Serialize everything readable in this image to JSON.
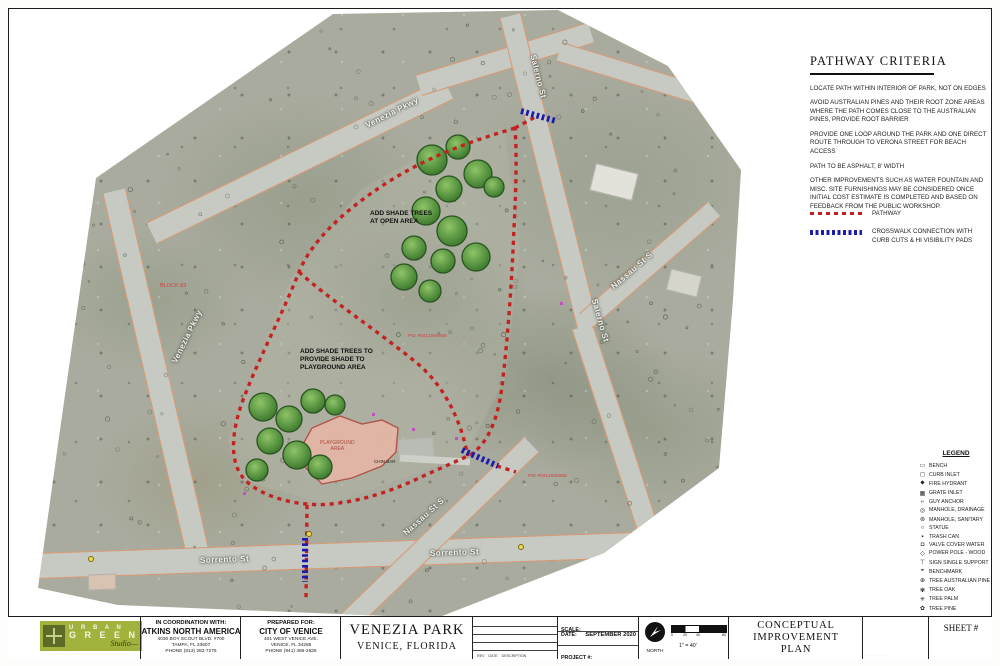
{
  "criteria": {
    "title": "PATHWAY CRITERIA",
    "paragraphs": [
      "LOCATE PATH WITHIN INTERIOR OF PARK, NOT ON EDGES",
      "AVOID AUSTRALIAN PINES AND THEIR ROOT ZONE AREAS WHERE THE PATH COMES CLOSE TO THE AUSTRALIAN PINES, PROVIDE ROOT BARRIER",
      "PROVIDE ONE LOOP AROUND THE PARK AND ONE DIRECT ROUTE THROUGH TO VERONA STREET FOR BEACH ACCESS",
      "PATH TO BE ASPHALT, 8' WIDTH",
      "OTHER IMPROVEMENTS SUCH AS WATER FOUNTAIN AND MISC. SITE FURNISHINGS MAY BE CONSIDERED ONCE INITIAL COST ESTIMATE IS COMPLETED AND BASED ON FEEDBACK FROM THE PUBLIC WORKSHOP."
    ],
    "pathway_label": "PATHWAY",
    "crosswalk_label": "CROSSWALK CONNECTION WITH CURB CUTS & HI VISIBILITY PADS",
    "pathway_color": "#c41f1f",
    "crosswalk_color": "#1c1caa"
  },
  "legend": {
    "title": "LEGEND",
    "items": [
      {
        "glyph": "▭",
        "label": "BENCH"
      },
      {
        "glyph": "◻",
        "label": "CURB INLET"
      },
      {
        "glyph": "⬥",
        "label": "FIRE HYDRANT"
      },
      {
        "glyph": "▦",
        "label": "GRATE INLET"
      },
      {
        "glyph": "⌐",
        "label": "GUY ANCHOR"
      },
      {
        "glyph": "◎",
        "label": "MANHOLE, DRAINAGE"
      },
      {
        "glyph": "⊚",
        "label": "MANHOLE, SANITARY"
      },
      {
        "glyph": "○",
        "label": "STATUE"
      },
      {
        "glyph": "▪",
        "label": "TRASH CAN"
      },
      {
        "glyph": "◘",
        "label": "VALVE COVER WATER"
      },
      {
        "glyph": "◇",
        "label": "POWER POLE - WOOD"
      },
      {
        "glyph": "⊤",
        "label": "SIGN SINGLE SUPPORT"
      },
      {
        "glyph": "⌖",
        "label": "BENCHMARK"
      },
      {
        "glyph": "⊕",
        "label": "TREE AUSTRALIAN PINE"
      },
      {
        "glyph": "✾",
        "label": "TREE OAK"
      },
      {
        "glyph": "✳",
        "label": "TREE PALM"
      },
      {
        "glyph": "✿",
        "label": "TREE PINE"
      }
    ]
  },
  "map": {
    "street_labels": [
      {
        "text": "Venezia Pkwy"
      },
      {
        "text": "Salerno St"
      },
      {
        "text": "Nassau St S"
      },
      {
        "text": "Salerno St"
      },
      {
        "text": "Venezia Pkwy"
      },
      {
        "text": "Sorrento St"
      },
      {
        "text": "Nassau St S"
      },
      {
        "text": "Sorrento St"
      }
    ],
    "notes": [
      {
        "text": "ADD SHADE TREES\nAT OPEN AREA"
      },
      {
        "text": "ADD SHADE TREES TO\nPROVIDE SHADE TO\nPLAYGROUND AREA"
      }
    ],
    "small_labels": {
      "block": "BLOCK 83",
      "pid_center": "PID #0412060056",
      "pid_east": "PID #0412060058",
      "playground": "PLAYGROUND\nAREA",
      "chin_bar": "CHIN BAR"
    }
  },
  "titleblock": {
    "logo": {
      "word1": "U R B A N",
      "word2": "G R E E N",
      "word3": "Studio—",
      "fineprint": "· · · · · · · · · · · · · · · · · · · · · · · ·"
    },
    "coordination": {
      "heading": "IN COORDINATION WITH:",
      "company": "ATKINS NORTH AMERICA",
      "address1": "4030 BOY SCOUT BLVD. #700",
      "address2": "TAMPA, FL 33607",
      "phone": "PHONE (813) 282-7275"
    },
    "prepared": {
      "heading": "PREPARED FOR:",
      "company": "CITY OF VENICE",
      "address1": "401 WEST VENICE AVE.",
      "address2": "VENICE, FL 34285",
      "phone": "PHONE (941) 486-2626"
    },
    "project": {
      "name": "VENEZIA PARK",
      "location": "VENICE, FLORIDA"
    },
    "revision": {
      "h1": "REV",
      "h2": "DATE",
      "h3": "DESCRIPTION"
    },
    "meta": {
      "scale_label": "SCALE:",
      "date_label": "DATE:",
      "date_value": "SEPTEMBER 2020",
      "project_label": "PROJECT #:"
    },
    "north_label": "NORTH",
    "scalebar": {
      "t0": "0",
      "t1": "20",
      "t2": "40",
      "t3": "80",
      "ratio": "1\" = 40'"
    },
    "plan_title": {
      "line1": "CONCEPTUAL",
      "line2": "IMPROVEMENT",
      "line3": "PLAN"
    },
    "micro": "· · · · · · · · · · · · ·",
    "sheet_label": "SHEET #"
  }
}
